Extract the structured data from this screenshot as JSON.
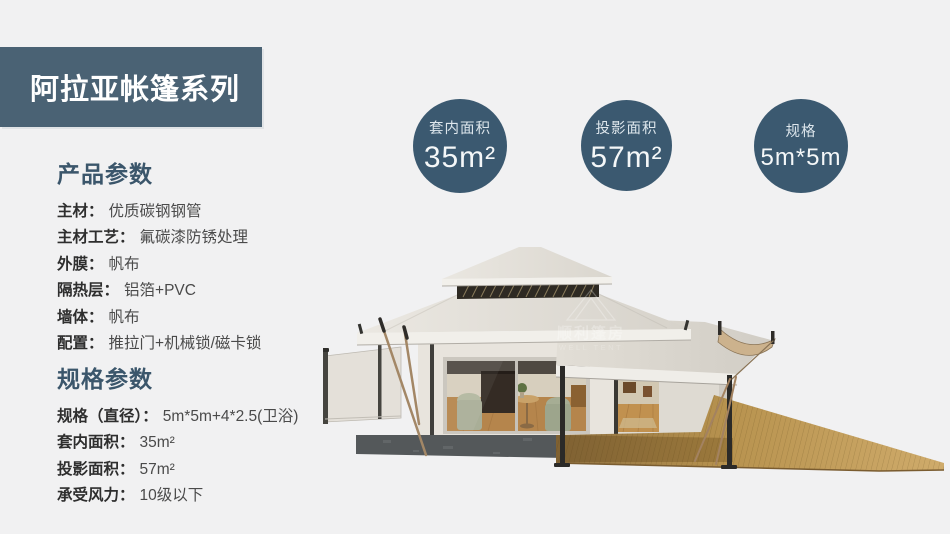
{
  "banner": {
    "title": "阿拉亚帐篷系列"
  },
  "badges": [
    {
      "label": "套内面积",
      "value": "35m²"
    },
    {
      "label": "投影面积",
      "value": "57m²"
    },
    {
      "label": "规格",
      "value": "5m*5m"
    }
  ],
  "product_params": {
    "heading": "产品参数",
    "rows": [
      {
        "label": "主材：",
        "value": "优质碳钢钢管"
      },
      {
        "label": "主材工艺：",
        "value": "氟碳漆防锈处理"
      },
      {
        "label": "外膜：",
        "value": "帆布"
      },
      {
        "label": "隔热层：",
        "value": "铝箔+PVC"
      },
      {
        "label": "墙体：",
        "value": "帆布"
      },
      {
        "label": "配置：",
        "value": "推拉门+机械锁/磁卡锁"
      }
    ]
  },
  "spec_params": {
    "heading": "规格参数",
    "rows": [
      {
        "label": "规格（直径）：",
        "value": "5m*5m+4*2.5(卫浴)"
      },
      {
        "label": "套内面积：",
        "value": "35m²"
      },
      {
        "label": "投影面积：",
        "value": "57m²"
      },
      {
        "label": "承受风力：",
        "value": "10级以下"
      }
    ]
  },
  "watermark": {
    "cn": "顺利篷房",
    "en": "WELL TENT"
  },
  "colors": {
    "page_bg": "#f1f1f2",
    "banner_bg": "#4a6274",
    "badge_bg": "#3b5970",
    "heading": "#3b566b",
    "tent_canvas": "#e8e4dd",
    "deck_wood": "#c9a767"
  }
}
